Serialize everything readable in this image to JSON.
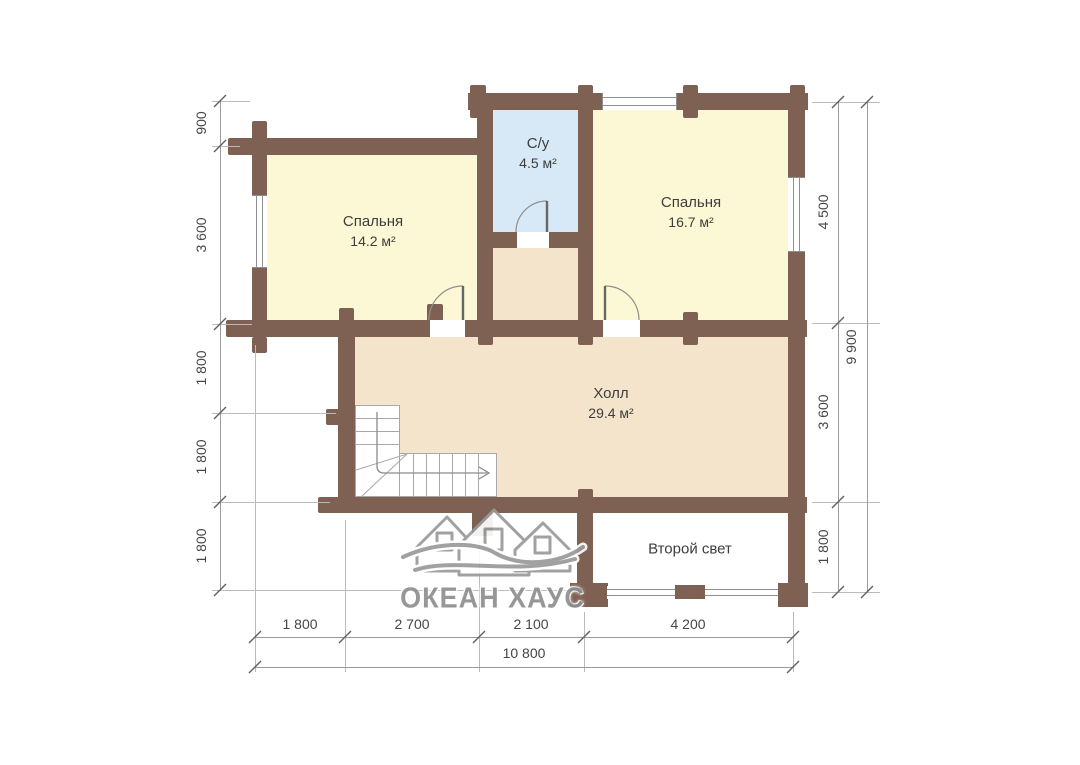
{
  "rooms": [
    {
      "name": "Спальня",
      "area": "14.2 м²"
    },
    {
      "name": "С/у",
      "area": "4.5 м²"
    },
    {
      "name": "Спальня",
      "area": "16.7 м²"
    },
    {
      "name": "Холл",
      "area": "29.4 м²"
    },
    {
      "name": "Второй свет",
      "area": ""
    }
  ],
  "dimensions": {
    "left": [
      "900",
      "3 600",
      "1 800",
      "1 800",
      "1 800"
    ],
    "right": [
      "4 500",
      "3 600",
      "1 800"
    ],
    "right_total": "9 900",
    "bottom": [
      "1 800",
      "2 700",
      "2 100",
      "4 200"
    ],
    "bottom_total": "10 800"
  },
  "logo": {
    "text": "ОКЕАН ХАУС"
  },
  "colors": {
    "wall": "#7e6152",
    "bedroom_fill": "#fcf8d5",
    "bathroom_fill": "#d7e9f7",
    "hall_fill": "#f4e4cc",
    "dim_line": "#9a9a9a",
    "text": "#3d3d3d"
  }
}
